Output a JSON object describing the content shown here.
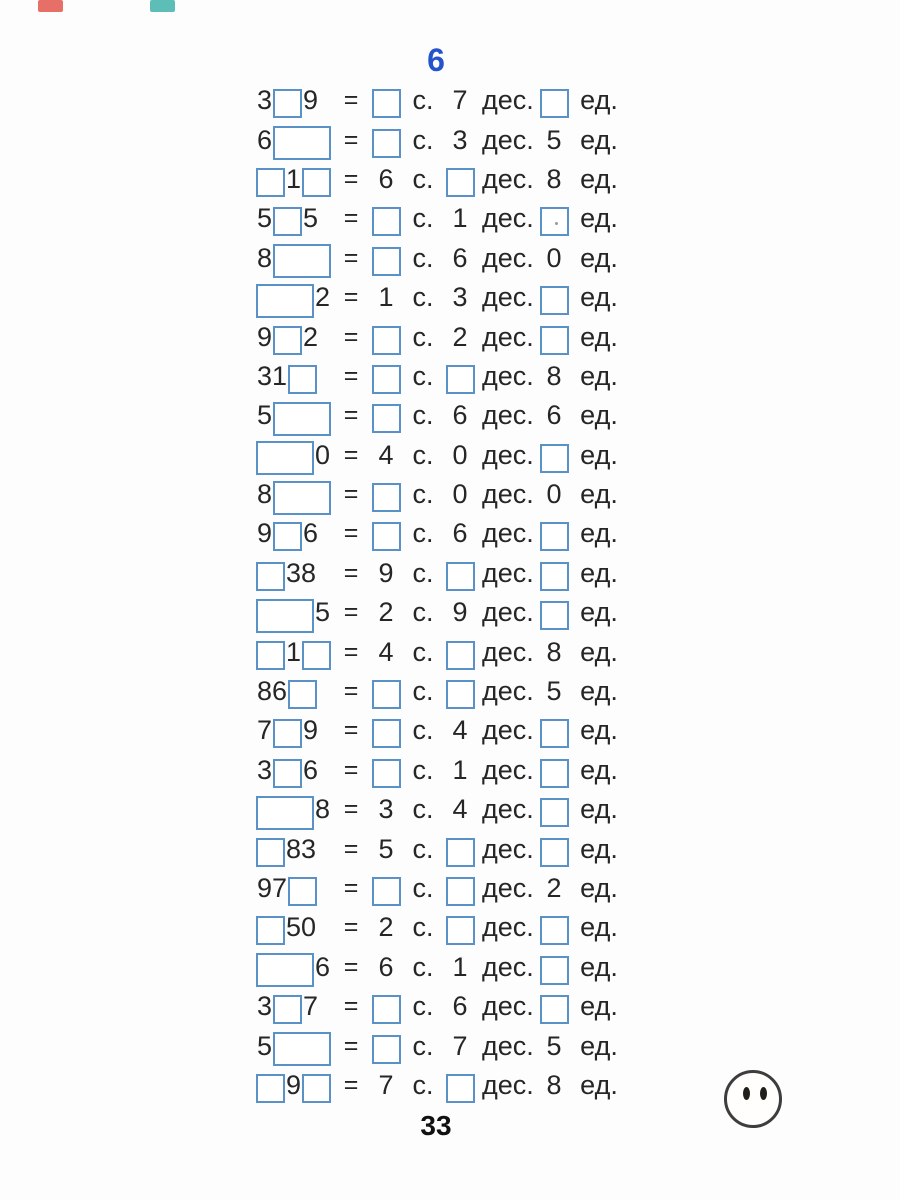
{
  "page": {
    "exercise_number": "6",
    "page_number": "33",
    "labels": {
      "equals": "=",
      "hundreds": "с.",
      "tens": "дес.",
      "units": "ед."
    },
    "colors": {
      "bg": "#fdfdfd",
      "text": "#262626",
      "box_border": "#5a92c8",
      "header_blue": "#2453cc",
      "mark_red": "#e2574c",
      "mark_teal": "#3fb3a9"
    },
    "icons": {
      "smiley": "smiley-face-no-mouth"
    },
    "rows": [
      {
        "num": [
          {
            "t": "d",
            "v": "3"
          },
          {
            "t": "b"
          },
          {
            "t": "d",
            "v": "9"
          }
        ],
        "h": {
          "t": "b"
        },
        "tens": {
          "t": "d",
          "v": "7"
        },
        "units": {
          "t": "b"
        }
      },
      {
        "num": [
          {
            "t": "d",
            "v": "6"
          },
          {
            "t": "w"
          }
        ],
        "h": {
          "t": "b"
        },
        "tens": {
          "t": "d",
          "v": "3"
        },
        "units": {
          "t": "d",
          "v": "5"
        }
      },
      {
        "num": [
          {
            "t": "b"
          },
          {
            "t": "d",
            "v": "1"
          },
          {
            "t": "b"
          }
        ],
        "h": {
          "t": "d",
          "v": "6"
        },
        "tens": {
          "t": "b"
        },
        "units": {
          "t": "d",
          "v": "8"
        }
      },
      {
        "num": [
          {
            "t": "d",
            "v": "5"
          },
          {
            "t": "b"
          },
          {
            "t": "d",
            "v": "5"
          }
        ],
        "h": {
          "t": "b"
        },
        "tens": {
          "t": "d",
          "v": "1"
        },
        "units": {
          "t": "b",
          "dot": true
        }
      },
      {
        "num": [
          {
            "t": "d",
            "v": "8"
          },
          {
            "t": "w"
          }
        ],
        "h": {
          "t": "b"
        },
        "tens": {
          "t": "d",
          "v": "6"
        },
        "units": {
          "t": "d",
          "v": "0"
        }
      },
      {
        "num": [
          {
            "t": "w"
          },
          {
            "t": "d",
            "v": "2"
          }
        ],
        "h": {
          "t": "d",
          "v": "1"
        },
        "tens": {
          "t": "d",
          "v": "3"
        },
        "units": {
          "t": "b"
        }
      },
      {
        "num": [
          {
            "t": "d",
            "v": "9"
          },
          {
            "t": "b"
          },
          {
            "t": "d",
            "v": "2"
          }
        ],
        "h": {
          "t": "b"
        },
        "tens": {
          "t": "d",
          "v": "2"
        },
        "units": {
          "t": "b"
        }
      },
      {
        "num": [
          {
            "t": "d",
            "v": "31"
          },
          {
            "t": "b"
          }
        ],
        "h": {
          "t": "b"
        },
        "tens": {
          "t": "b"
        },
        "units": {
          "t": "d",
          "v": "8"
        }
      },
      {
        "num": [
          {
            "t": "d",
            "v": "5"
          },
          {
            "t": "w"
          }
        ],
        "h": {
          "t": "b"
        },
        "tens": {
          "t": "d",
          "v": "6"
        },
        "units": {
          "t": "d",
          "v": "6"
        }
      },
      {
        "num": [
          {
            "t": "w"
          },
          {
            "t": "d",
            "v": "0"
          }
        ],
        "h": {
          "t": "d",
          "v": "4"
        },
        "tens": {
          "t": "d",
          "v": "0"
        },
        "units": {
          "t": "b"
        }
      },
      {
        "num": [
          {
            "t": "d",
            "v": "8"
          },
          {
            "t": "w"
          }
        ],
        "h": {
          "t": "b"
        },
        "tens": {
          "t": "d",
          "v": "0"
        },
        "units": {
          "t": "d",
          "v": "0"
        }
      },
      {
        "num": [
          {
            "t": "d",
            "v": "9"
          },
          {
            "t": "b"
          },
          {
            "t": "d",
            "v": "6"
          }
        ],
        "h": {
          "t": "b"
        },
        "tens": {
          "t": "d",
          "v": "6"
        },
        "units": {
          "t": "b"
        }
      },
      {
        "num": [
          {
            "t": "b"
          },
          {
            "t": "d",
            "v": "38"
          }
        ],
        "h": {
          "t": "d",
          "v": "9"
        },
        "tens": {
          "t": "b"
        },
        "units": {
          "t": "b"
        }
      },
      {
        "num": [
          {
            "t": "w"
          },
          {
            "t": "d",
            "v": "5"
          }
        ],
        "h": {
          "t": "d",
          "v": "2"
        },
        "tens": {
          "t": "d",
          "v": "9"
        },
        "units": {
          "t": "b"
        }
      },
      {
        "num": [
          {
            "t": "b"
          },
          {
            "t": "d",
            "v": "1"
          },
          {
            "t": "b"
          }
        ],
        "h": {
          "t": "d",
          "v": "4"
        },
        "tens": {
          "t": "b"
        },
        "units": {
          "t": "d",
          "v": "8"
        }
      },
      {
        "num": [
          {
            "t": "d",
            "v": "86"
          },
          {
            "t": "b"
          }
        ],
        "h": {
          "t": "b"
        },
        "tens": {
          "t": "b"
        },
        "units": {
          "t": "d",
          "v": "5"
        }
      },
      {
        "num": [
          {
            "t": "d",
            "v": "7"
          },
          {
            "t": "b"
          },
          {
            "t": "d",
            "v": "9"
          }
        ],
        "h": {
          "t": "b"
        },
        "tens": {
          "t": "d",
          "v": "4"
        },
        "units": {
          "t": "b"
        }
      },
      {
        "num": [
          {
            "t": "d",
            "v": "3"
          },
          {
            "t": "b"
          },
          {
            "t": "d",
            "v": "6"
          }
        ],
        "h": {
          "t": "b"
        },
        "tens": {
          "t": "d",
          "v": "1"
        },
        "units": {
          "t": "b"
        }
      },
      {
        "num": [
          {
            "t": "w"
          },
          {
            "t": "d",
            "v": "8"
          }
        ],
        "h": {
          "t": "d",
          "v": "3"
        },
        "tens": {
          "t": "d",
          "v": "4"
        },
        "units": {
          "t": "b"
        }
      },
      {
        "num": [
          {
            "t": "b"
          },
          {
            "t": "d",
            "v": "83"
          }
        ],
        "h": {
          "t": "d",
          "v": "5"
        },
        "tens": {
          "t": "b"
        },
        "units": {
          "t": "b"
        }
      },
      {
        "num": [
          {
            "t": "d",
            "v": "97"
          },
          {
            "t": "b"
          }
        ],
        "h": {
          "t": "b"
        },
        "tens": {
          "t": "b"
        },
        "units": {
          "t": "d",
          "v": "2"
        }
      },
      {
        "num": [
          {
            "t": "b"
          },
          {
            "t": "d",
            "v": "50"
          }
        ],
        "h": {
          "t": "d",
          "v": "2"
        },
        "tens": {
          "t": "b"
        },
        "units": {
          "t": "b"
        }
      },
      {
        "num": [
          {
            "t": "w"
          },
          {
            "t": "d",
            "v": "6"
          }
        ],
        "h": {
          "t": "d",
          "v": "6"
        },
        "tens": {
          "t": "d",
          "v": "1"
        },
        "units": {
          "t": "b"
        }
      },
      {
        "num": [
          {
            "t": "d",
            "v": "3"
          },
          {
            "t": "b"
          },
          {
            "t": "d",
            "v": "7"
          }
        ],
        "h": {
          "t": "b"
        },
        "tens": {
          "t": "d",
          "v": "6"
        },
        "units": {
          "t": "b"
        }
      },
      {
        "num": [
          {
            "t": "d",
            "v": "5"
          },
          {
            "t": "w"
          }
        ],
        "h": {
          "t": "b"
        },
        "tens": {
          "t": "d",
          "v": "7"
        },
        "units": {
          "t": "d",
          "v": "5"
        }
      },
      {
        "num": [
          {
            "t": "b"
          },
          {
            "t": "d",
            "v": "9"
          },
          {
            "t": "b"
          }
        ],
        "h": {
          "t": "d",
          "v": "7"
        },
        "tens": {
          "t": "b"
        },
        "units": {
          "t": "d",
          "v": "8"
        }
      }
    ]
  }
}
